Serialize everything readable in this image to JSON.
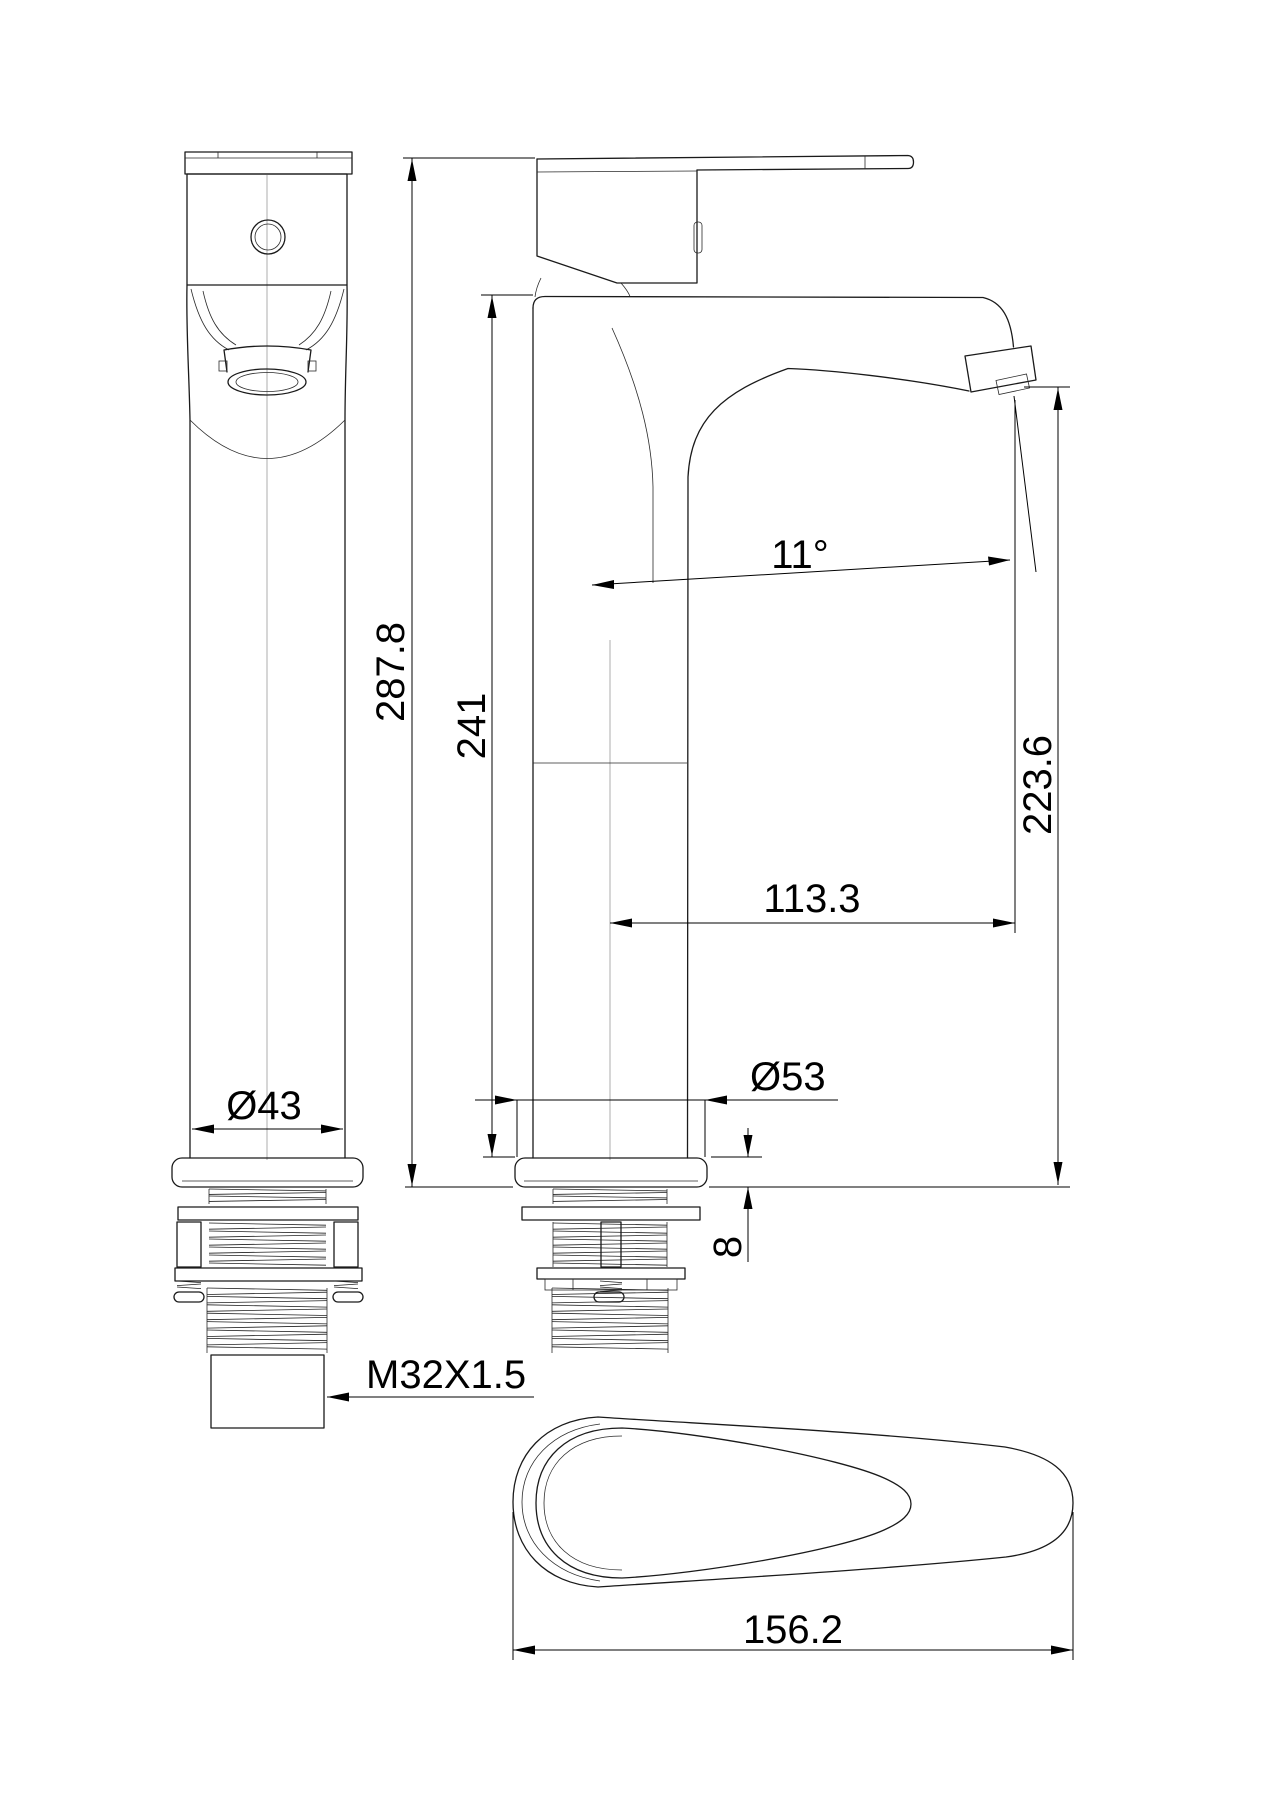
{
  "drawing": {
    "type": "technical-dimension-drawing",
    "subject": "tall single-lever basin mixer faucet",
    "views": {
      "front_view": "front view with mounting shank",
      "side_view": "side view with spout",
      "top_view": "handle top view"
    },
    "dims": {
      "overall_height": "287.8",
      "body_height": "241",
      "spout_height": "223.6",
      "spout_reach": "113.3",
      "spout_angle": "11°",
      "column_diameter": "Ø43",
      "base_diameter": "Ø53",
      "base_thickness": "8",
      "thread": "M32X1.5",
      "handle_length": "156.2"
    },
    "line_color": "#1a1a1a",
    "background": "#ffffff"
  }
}
